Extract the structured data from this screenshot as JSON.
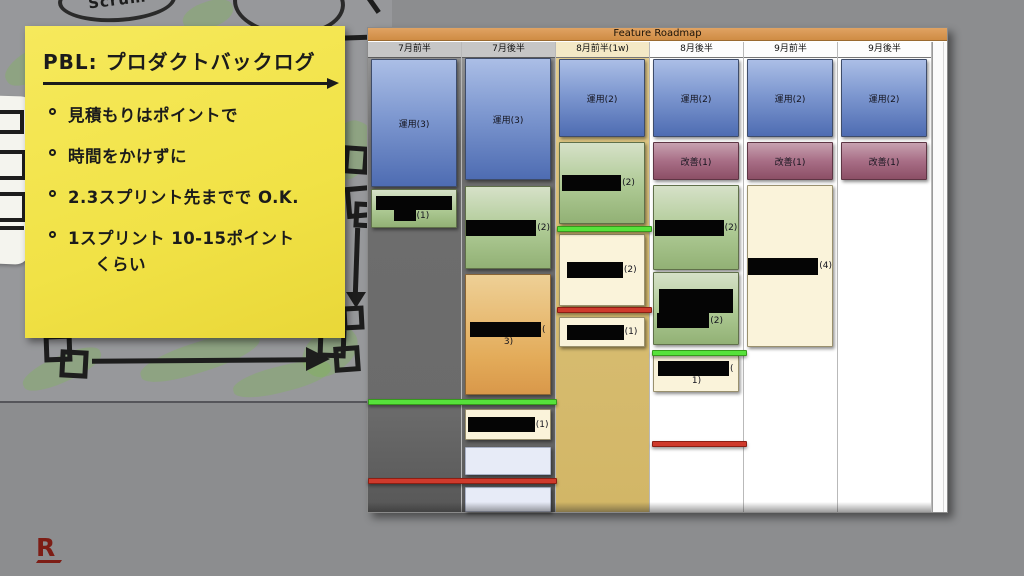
{
  "sticky_note": {
    "title": "PBL: プロダクトバックログ",
    "bullets": [
      "見積もりはポイントで",
      "時間をかけずに",
      "2.3スプリント先までで O.K.",
      "1スプリント 10-15ポイント"
    ],
    "continuation": "くらい"
  },
  "sketch": {
    "scrum_label": "Scrum"
  },
  "roadmap": {
    "title": "Feature Roadmap",
    "columns": [
      {
        "label": "7月前半",
        "cards": [
          {
            "kind": "ops",
            "label": "運用(3)"
          },
          {
            "kind": "redacted",
            "suffix": "(1)"
          }
        ]
      },
      {
        "label": "7月後半",
        "cards": [
          {
            "kind": "ops",
            "label": "運用(3)"
          },
          {
            "kind": "redacted",
            "suffix": "(2)"
          },
          {
            "kind": "redacted",
            "suffix": "(",
            "suffix2": "3)"
          },
          {
            "kind": "redacted",
            "suffix": "(1)"
          },
          {
            "kind": "empty"
          },
          {
            "kind": "empty"
          }
        ]
      },
      {
        "label": "8月前半(1w)",
        "cards": [
          {
            "kind": "ops",
            "label": "運用(2)"
          },
          {
            "kind": "redacted",
            "suffix": "(2)"
          },
          {
            "kind": "redacted",
            "suffix": "(2)"
          },
          {
            "kind": "redacted",
            "suffix": "(1)"
          }
        ]
      },
      {
        "label": "8月後半",
        "cards": [
          {
            "kind": "ops",
            "label": "運用(2)"
          },
          {
            "kind": "improve",
            "label": "改善(1)"
          },
          {
            "kind": "redacted",
            "suffix": "(2)"
          },
          {
            "kind": "redacted",
            "suffix": "(2)"
          },
          {
            "kind": "redacted",
            "suffix": "(",
            "suffix2": "1)"
          }
        ]
      },
      {
        "label": "9月前半",
        "cards": [
          {
            "kind": "ops",
            "label": "運用(2)"
          },
          {
            "kind": "improve",
            "label": "改善(1)"
          },
          {
            "kind": "redacted",
            "suffix": "(4)"
          }
        ]
      },
      {
        "label": "9月後半",
        "cards": [
          {
            "kind": "ops",
            "label": "運用(2)"
          },
          {
            "kind": "improve",
            "label": "改善(1)"
          }
        ]
      }
    ]
  },
  "logo": {
    "letter": "R"
  },
  "colors": {
    "titlebar_orange": "#d6954f",
    "ops_blue": "#5f7cbf",
    "improve_maroon": "#9c5e74",
    "backlog_green": "#a7c18d",
    "story_orange": "#e0a652",
    "task_cream": "#faf3da",
    "milestone_green": "#56e23b",
    "milestone_red": "#cf3a2c",
    "note_yellow": "#f1e246",
    "logo_red": "#7d1d15"
  }
}
